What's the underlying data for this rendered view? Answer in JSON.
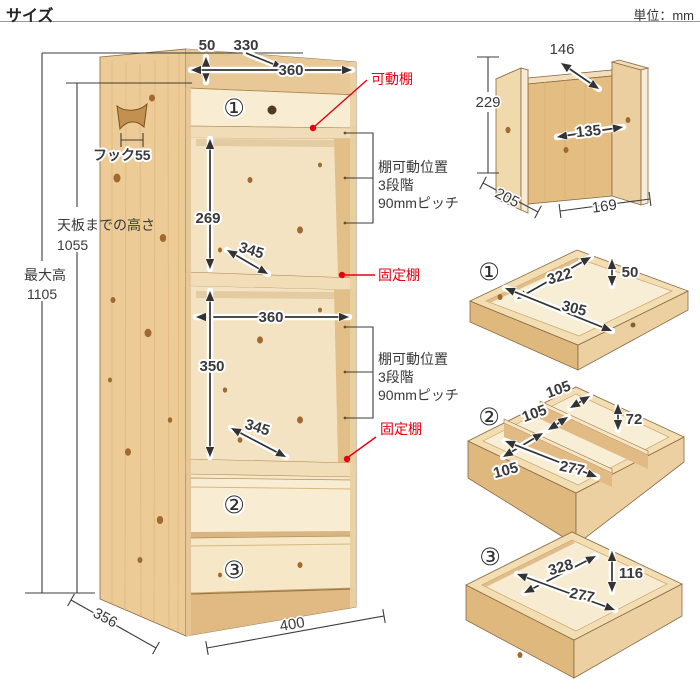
{
  "header": {
    "title": "サイズ",
    "unit": "単位：mm"
  },
  "colors": {
    "accent_red": "#e60012",
    "dim_line": "#3a3a3a",
    "wood_light": "#f7ead0",
    "wood_mid": "#eccb97",
    "wood_dark": "#dfb87e",
    "outline": "#8a6a42"
  },
  "cabinet": {
    "top_thickness": "50",
    "top_inner_width": "330",
    "top_outer_width": "360",
    "movable_shelf_label": "可動棚",
    "hook_label": "フック55",
    "upper_inner_height": "269",
    "upper_shelf_depth": "345",
    "fixed_shelf_label_1": "固定棚",
    "adjust_1": {
      "l1": "棚可動位置",
      "l2": "3段階",
      "l3": "90mmピッチ"
    },
    "height_to_top_label": "天板までの高さ",
    "height_to_top_value": "1055",
    "max_height_label": "最大高",
    "max_height_value": "1105",
    "middle_inner_width": "360",
    "lower_inner_height": "350",
    "lower_shelf_depth": "345",
    "adjust_2": {
      "l1": "棚可動位置",
      "l2": "3段階",
      "l3": "90mmピッチ"
    },
    "fixed_shelf_label_2": "固定棚",
    "drawer1_no": "①",
    "drawer2_no": "②",
    "drawer3_no": "③",
    "depth": "356",
    "width": "400"
  },
  "side_piece": {
    "top_depth": "146",
    "height": "229",
    "inner_width": "135",
    "depth": "205",
    "width": "169"
  },
  "tray1": {
    "no": "①",
    "inner_depth": "322",
    "inner_height": "50",
    "inner_width": "305"
  },
  "tray2": {
    "no": "②",
    "slot_width_1": "105",
    "slot_width_2": "105",
    "inner_height": "72",
    "slot_width_3": "105",
    "inner_length": "277"
  },
  "tray3": {
    "no": "③",
    "inner_depth": "328",
    "inner_height": "116",
    "inner_width": "277"
  }
}
